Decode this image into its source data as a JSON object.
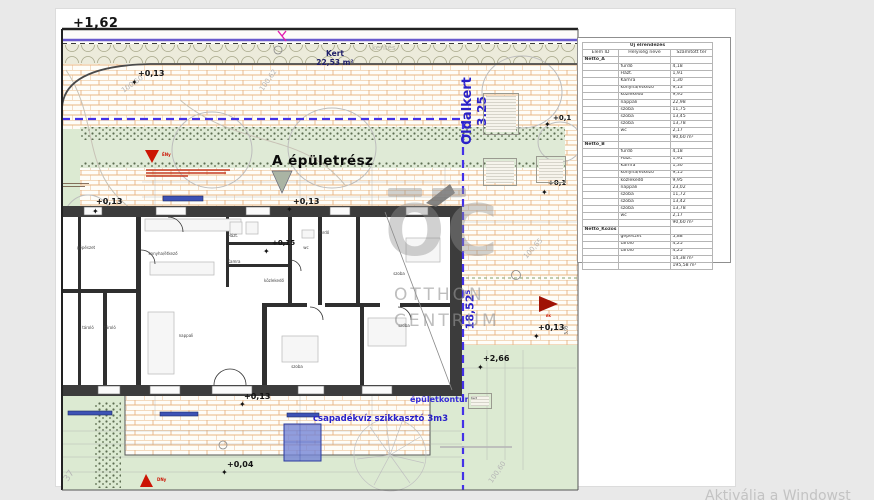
{
  "colors": {
    "accent_blue": "#2a21c8",
    "boundary_dash": "#4431e8",
    "purple_line": "#6a5acd",
    "paver_line": "#e2a468",
    "garden_green": "#dcead2",
    "marker_red": "#cc1504",
    "watermark_gray": "#c3c3c3"
  },
  "icons": {
    "level_marker": "✦"
  },
  "plan": {
    "frame_level": "+1,62",
    "kert": {
      "name": "Kert",
      "area": "22,53 m²"
    },
    "kerites": "kerítés",
    "oldalkert": {
      "name": "Oldalkert",
      "value": "3,25"
    },
    "building_label": "A épületrész",
    "dim_side": "18,52⁵",
    "dim_small": "5,95",
    "epuletkontur": "épületkontúr",
    "szikkaszto": "csapadékvíz szikkasztó 3m3",
    "kert_box": "Kert",
    "compass": {
      "nw": "ÉNy",
      "sw": "DNy",
      "e": "ÉK"
    },
    "levels": [
      "+0,13",
      "+0,13",
      "+0,13",
      "+0,15",
      "+0,1",
      "+0,1",
      "+0,13",
      "+2,66",
      "+0,13",
      "+0,04"
    ],
    "survey": [
      "100,62",
      "100,50",
      "100,65",
      "100,60",
      "37"
    ],
    "rooms": [
      "gépészet",
      "konyha/étkező",
      "Házt.",
      "Kamra",
      "tároló",
      "tároló",
      "nappali",
      "fürdő",
      "wc",
      "közlekedő",
      "szoba",
      "szoba",
      "szoba"
    ]
  },
  "table": {
    "title": "Új elrendezés",
    "columns": [
      "Elem ID",
      "Helyiség neve",
      "Számított ter"
    ],
    "sections": [
      {
        "id": "Nettó_A",
        "rows": [
          [
            "fürdő",
            "4,18"
          ],
          [
            "Házt.",
            "1,91"
          ],
          [
            "Kamra",
            "1,30"
          ],
          [
            "konyha/étkező",
            "9,13"
          ],
          [
            "közlekedő",
            "9,95"
          ],
          [
            "nappali",
            "22,98"
          ],
          [
            "szoba",
            "11,75"
          ],
          [
            "szoba",
            "13,45"
          ],
          [
            "szoba",
            "13,78"
          ],
          [
            "wc",
            "2,17"
          ]
        ],
        "total": "90,60 m²"
      },
      {
        "id": "Nettó_B",
        "rows": [
          [
            "fürdő",
            "4,18"
          ],
          [
            "Házt.",
            "1,91"
          ],
          [
            "Kamra",
            "1,30"
          ],
          [
            "konyha/étkező",
            "9,15"
          ],
          [
            "közlekedő",
            "9,95"
          ],
          [
            "nappali",
            "23,02"
          ],
          [
            "szoba",
            "11,72"
          ],
          [
            "szoba",
            "13,42"
          ],
          [
            "szoba",
            "13,78"
          ],
          [
            "wc",
            "2,17"
          ]
        ],
        "total": "90,60 m²"
      },
      {
        "id": "Nettó_Közös",
        "rows": [
          [
            "gépészet",
            "5,88"
          ],
          [
            "tároló",
            "4,25"
          ],
          [
            "tároló",
            "4,25"
          ]
        ],
        "total": "14,38 m²"
      }
    ],
    "grand_total": "195,58 m²"
  },
  "watermark": {
    "logo": "OC",
    "line1": "OTTHON",
    "line2": "CENTRUM"
  },
  "system": {
    "activation": "Aktiválja a Windowst"
  }
}
